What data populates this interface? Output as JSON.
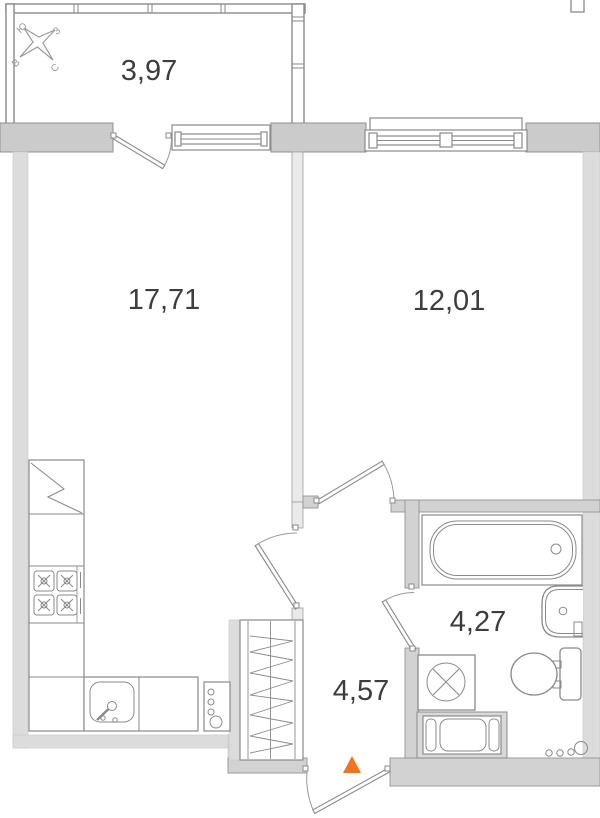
{
  "plan": {
    "title": "one-room apartment floor plan",
    "units": "m2",
    "rooms": [
      {
        "id": "balcony",
        "area": "3,97"
      },
      {
        "id": "living-kitchen",
        "area": "17,71"
      },
      {
        "id": "bedroom",
        "area": "12,01"
      },
      {
        "id": "hallway",
        "area": "4,57"
      },
      {
        "id": "bathroom",
        "area": "4,27"
      }
    ],
    "compass": {
      "north": "С",
      "south": "Ю",
      "east": "В",
      "west": "З"
    },
    "colors": {
      "entrance_marker": "#ee7420",
      "wall_dark": "#cbcbcb",
      "wall_light": "#dcdcdc",
      "outline": "#8a8a8a",
      "label_text": "#3d3d3d"
    },
    "fixtures": [
      "compass-rose-icon",
      "balcony-railing",
      "balcony-door-icon",
      "balcony-window-icon",
      "bedroom-window-icon",
      "refrigerator-icon",
      "stove-icon",
      "kitchen-sink-icon",
      "riser-pipes-icon",
      "wardrobe-icon",
      "bathtub-icon",
      "washbasin-icon",
      "toilet-icon",
      "washing-machine-icon",
      "ventilation-shaft-icon",
      "entrance-marker-icon",
      "entrance-door-icon"
    ]
  }
}
